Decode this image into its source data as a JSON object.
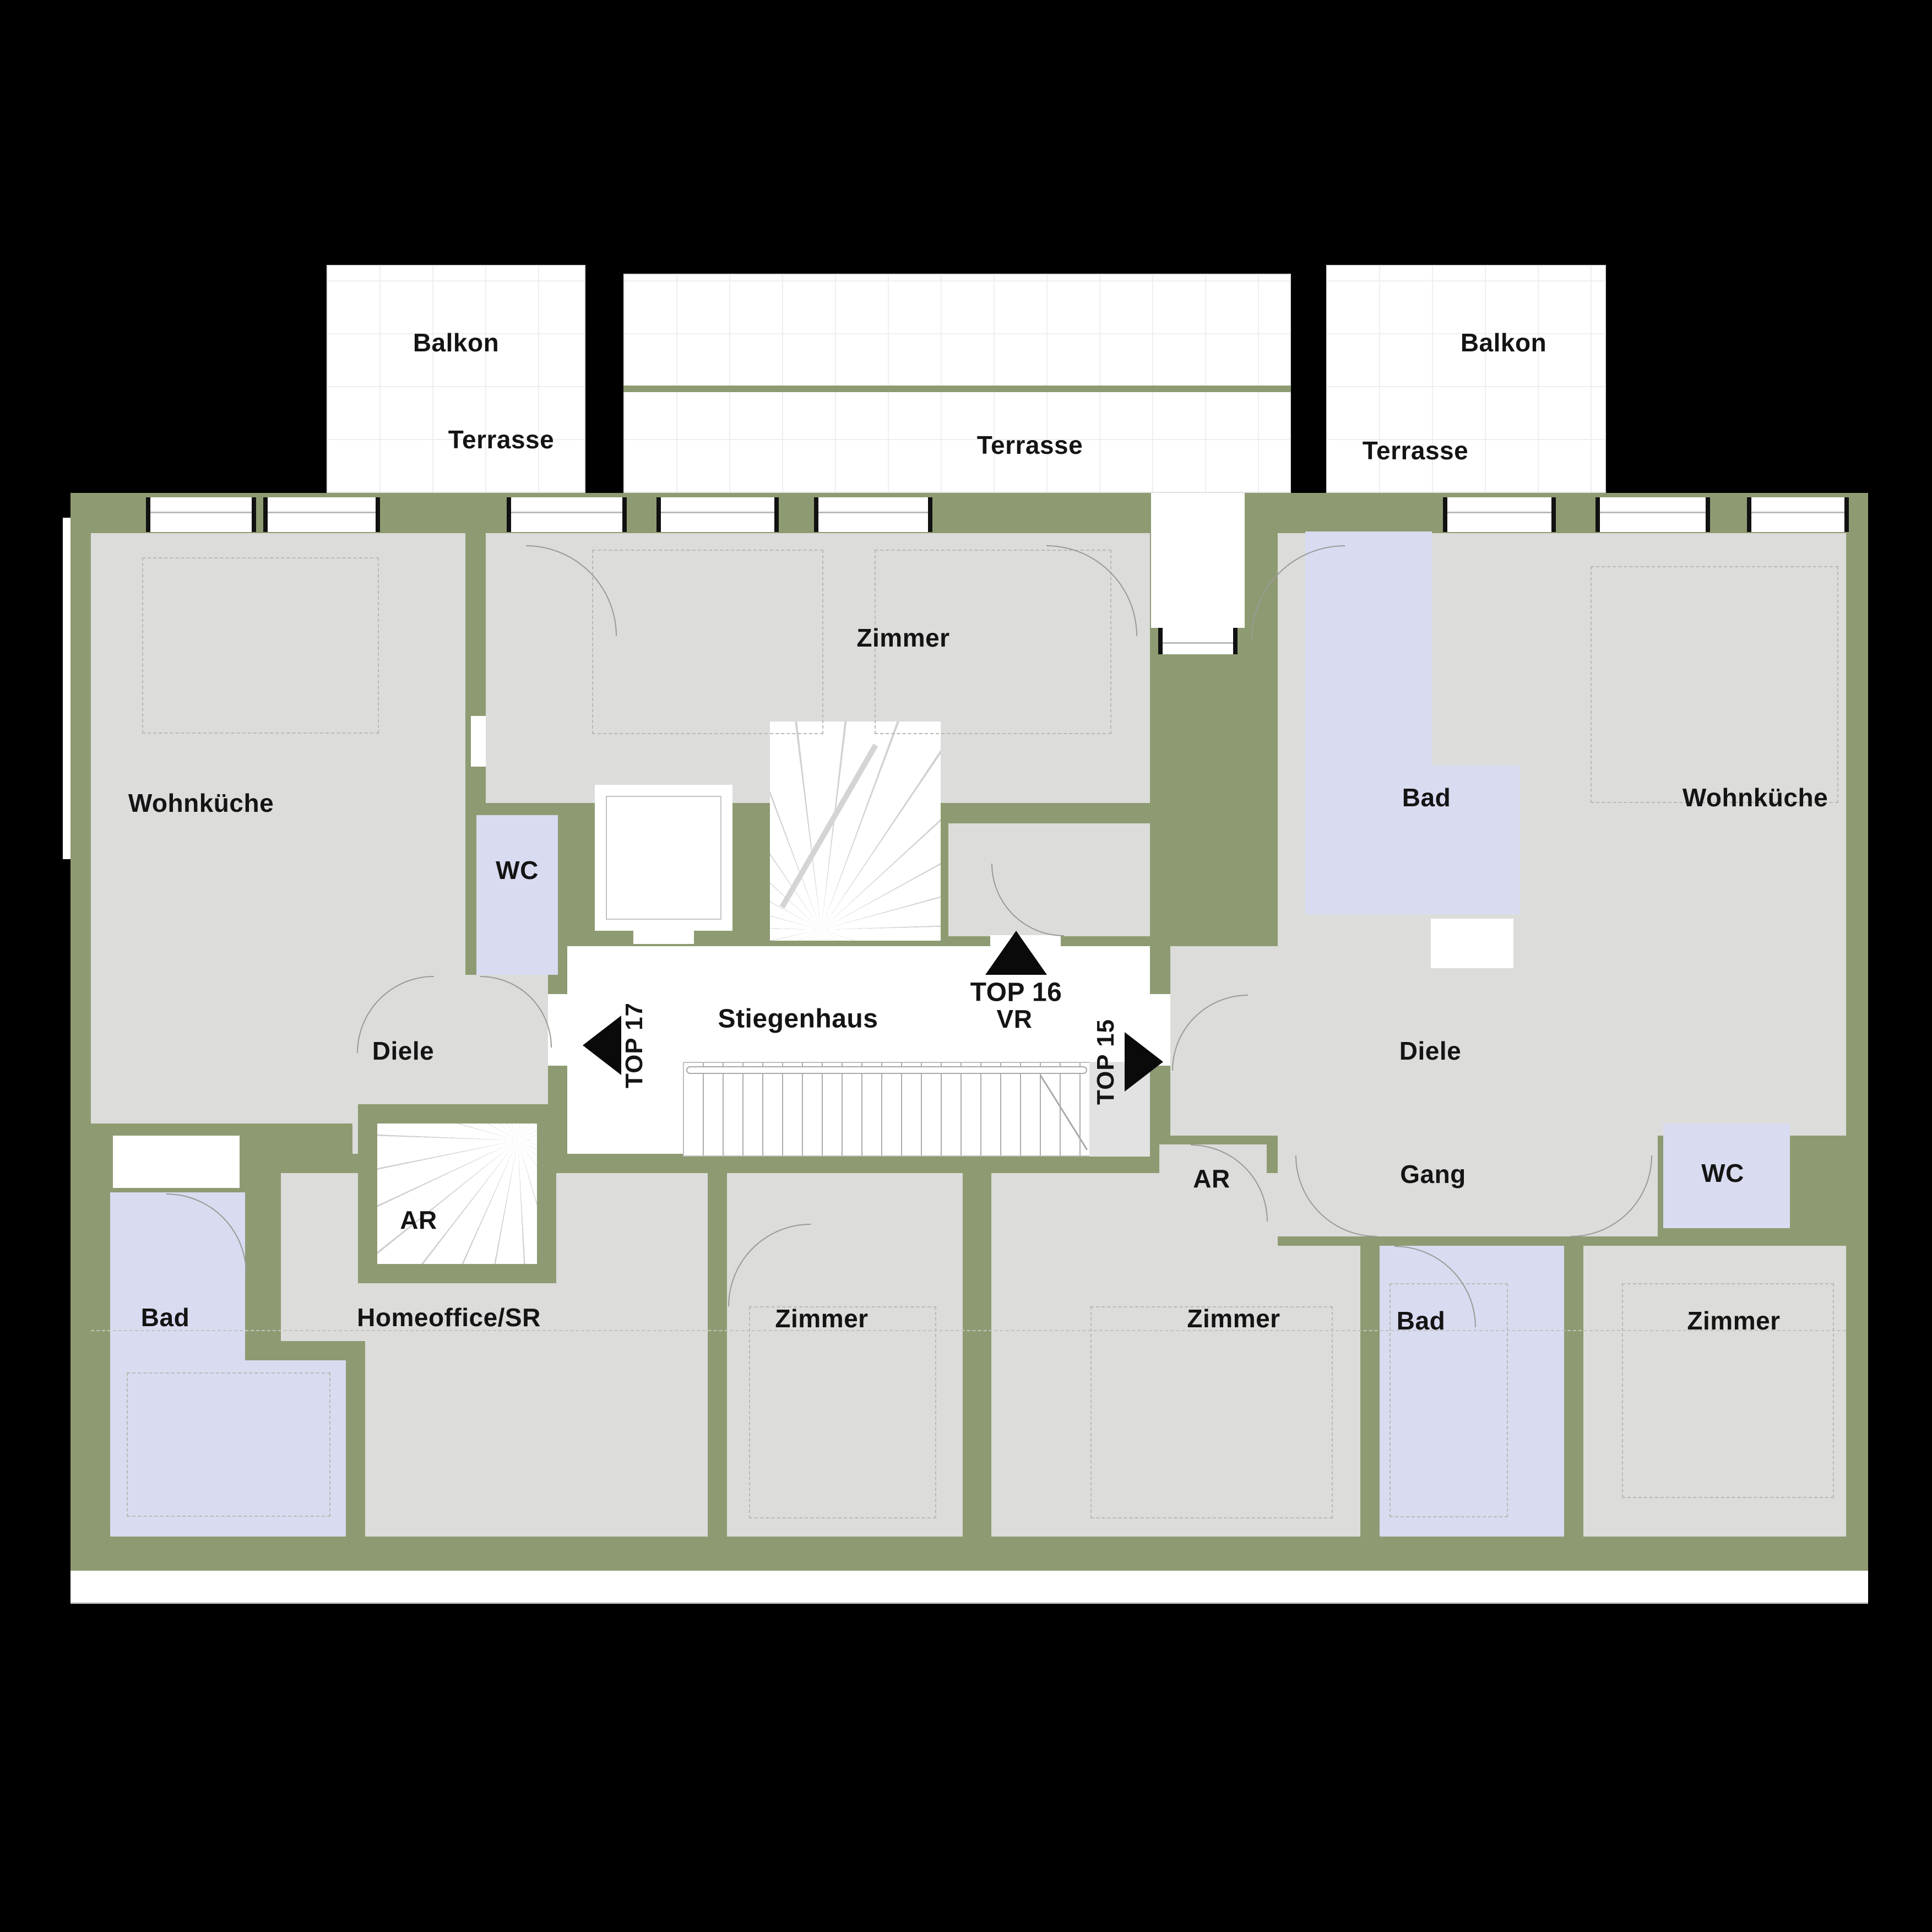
{
  "colors": {
    "bg": "#000000",
    "wall": "#8e9b72",
    "floor": "#dcdcda",
    "wet": "#d9dbf1",
    "paper": "#ffffff",
    "ink": "#141414",
    "line": "#9a9a96",
    "dash": "#b9b9b4"
  },
  "outdoor": {
    "balkon_left": "Balkon",
    "terrasse_left": "Terrasse",
    "terrasse_middle": "Terrasse",
    "balkon_right": "Balkon",
    "terrasse_right": "Terrasse"
  },
  "rooms": {
    "zimmer_top": "Zimmer",
    "wohnkueche_left": "Wohnküche",
    "wohnkueche_right": "Wohnküche",
    "wc_left": "WC",
    "bad_top_right": "Bad",
    "stiegenhaus": "Stiegenhaus",
    "diele_left": "Diele",
    "diele_right": "Diele",
    "ar_left": "AR",
    "ar_right": "AR",
    "gang": "Gang",
    "wc_right": "WC",
    "bad_bottom_left": "Bad",
    "homeoffice": "Homeoffice/SR",
    "zimmer_bottom_left": "Zimmer",
    "zimmer_bottom_mid": "Zimmer",
    "bad_bottom_right": "Bad",
    "zimmer_bottom_right": "Zimmer"
  },
  "units": {
    "top17": {
      "label": "TOP 17"
    },
    "top16": {
      "label": "TOP 16",
      "vestibule": "VR"
    },
    "top15": {
      "label": "TOP 15"
    }
  }
}
